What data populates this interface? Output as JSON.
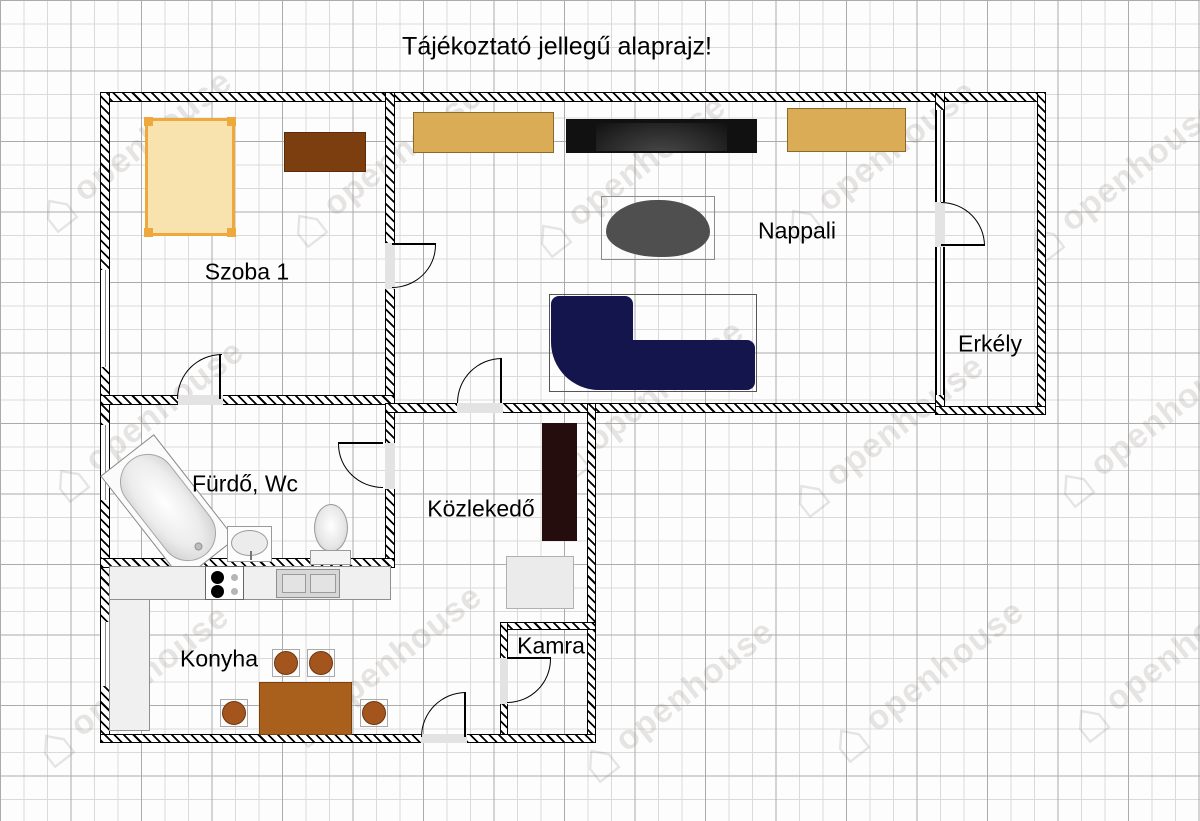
{
  "title": "Tájékoztató jellegű alaprajz!",
  "watermark": {
    "text": "openhouse",
    "icon": "house-icon"
  },
  "rooms": [
    {
      "id": "szoba1",
      "label": "Szoba 1"
    },
    {
      "id": "nappali",
      "label": "Nappali"
    },
    {
      "id": "erkely",
      "label": "Erkély"
    },
    {
      "id": "furdo",
      "label": "Fürdő, Wc"
    },
    {
      "id": "kozlekedo",
      "label": "Közlekedő"
    },
    {
      "id": "konyha",
      "label": "Konyha"
    },
    {
      "id": "kamra",
      "label": "Kamra"
    }
  ],
  "colors": {
    "bed_fill": "#f8e3ae",
    "bed_frame": "#eda93c",
    "dresser_brown": "#7c3d0f",
    "cabinet_tan": "#d9ac55",
    "tv_black": "#111111",
    "coffee_table_gray": "#4f4f4f",
    "sofa_navy": "#15154e",
    "wardrobe_dark": "#250d0d",
    "kitchen_table_brown": "#a9601c",
    "chair_brown": "#a4551e",
    "counter_gray": "#f0f0f0",
    "grid_minor": "#dadada",
    "grid_major": "#ababab"
  }
}
